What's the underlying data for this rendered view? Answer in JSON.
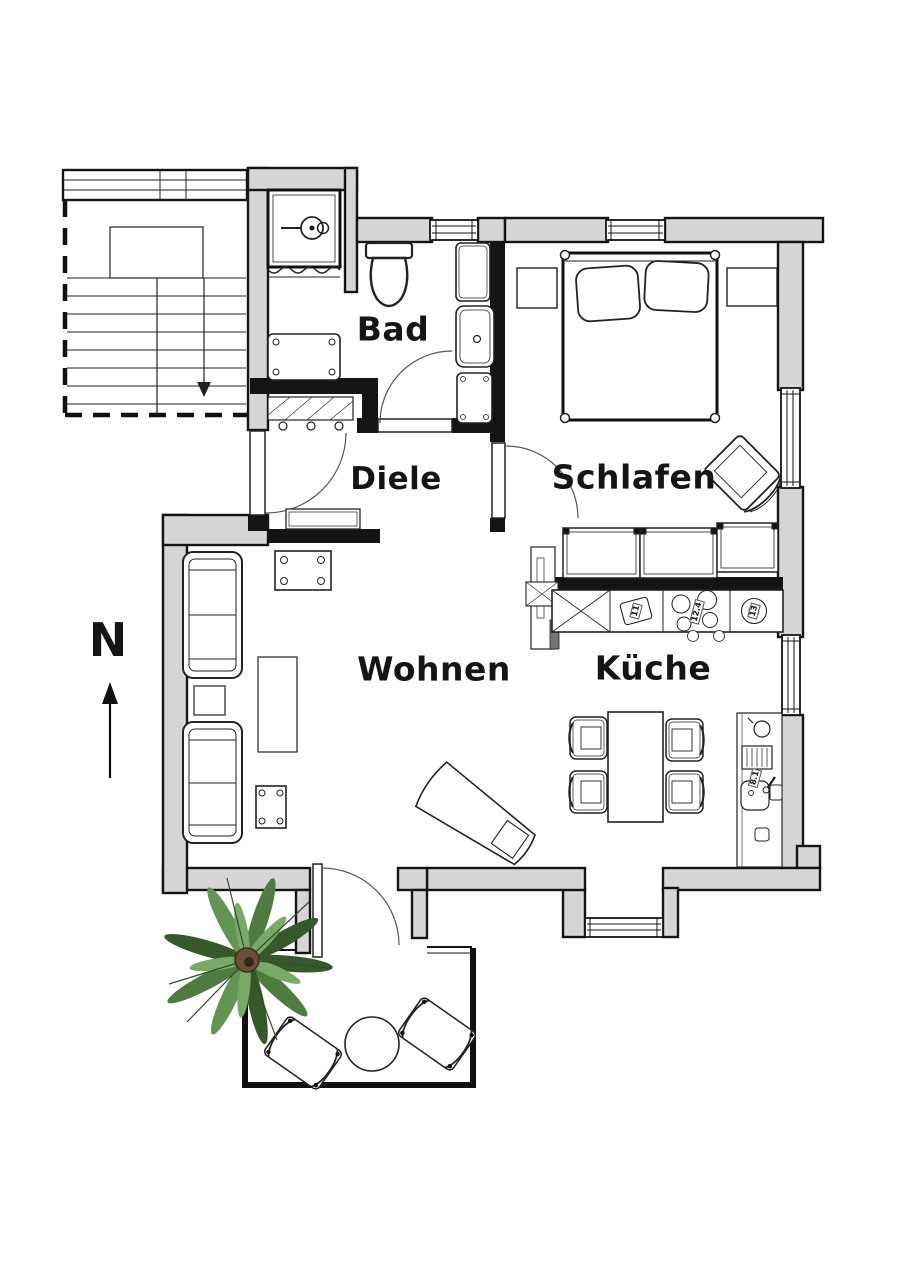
{
  "floorplan": {
    "type": "apartment-floor-plan",
    "compass_label": "N",
    "rooms": [
      {
        "id": "bad",
        "label": "Bad"
      },
      {
        "id": "diele",
        "label": "Diele"
      },
      {
        "id": "schlafen",
        "label": "Schlafen"
      },
      {
        "id": "wohnen",
        "label": "Wohnen"
      },
      {
        "id": "kueche",
        "label": "Küche"
      }
    ],
    "appliance_labels": [
      {
        "id": "kitchen-appliance",
        "label": "11"
      },
      {
        "id": "kitchen-cooktop",
        "label": "12.4"
      },
      {
        "id": "kitchen-oven",
        "label": "13"
      },
      {
        "id": "kitchen-sink",
        "label": "8.1"
      }
    ],
    "colors": {
      "wall_fill": "#d6d6d6",
      "line": "#141414",
      "plant_green_dark": "#36592c",
      "plant_green_mid": "#4e7c40",
      "plant_green_light": "#7aa869",
      "plant_pot_brown": "#6b4f38"
    }
  }
}
